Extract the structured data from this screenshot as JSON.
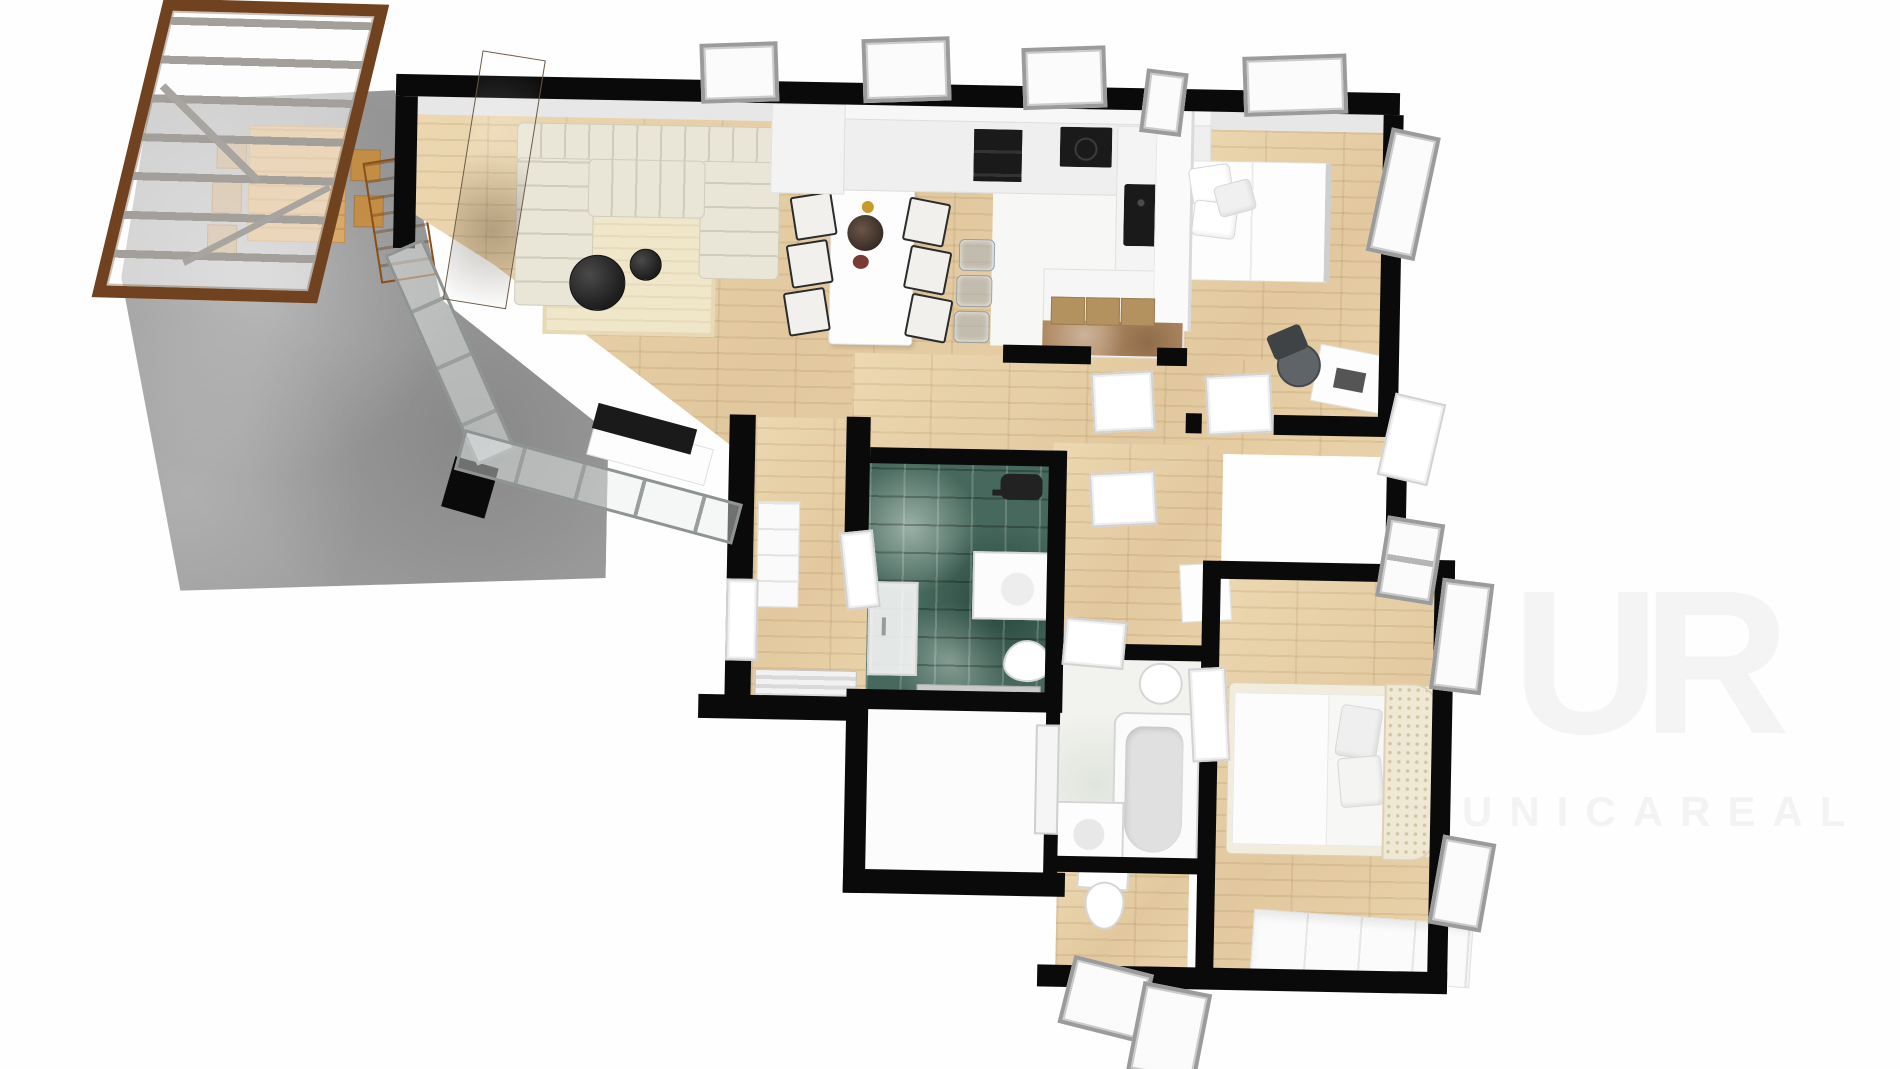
{
  "image": {
    "type": "3d-floor-plan-render",
    "view": "top-down-perspective",
    "visible_text_only": "watermark"
  },
  "watermark": {
    "logo_text": "UR",
    "brand_text": "UNICAREAL"
  },
  "palette": {
    "background": "#ffffff",
    "walls": "#0a0a0a",
    "wood_floor": "#e7d2ab",
    "terrace_concrete": "#9e9e9e",
    "bathroom_tile_teal": "#47685c",
    "sofa_cream": "#e9e6d8",
    "rug_cream": "#f0e6ca",
    "pergola_wood_brown": "#70421f",
    "pergola_beam_gray": "#a39f9a",
    "coffee_table_black": "#1d1d1d",
    "kitchen_appliance_black": "#1a1a1a",
    "island_marble_tan": "#b08a64",
    "island_tatami_tan": "#b3925f",
    "window_frame_gray": "#9b9b9b",
    "bed_linen_white": "#fafafa",
    "rattan_headboard_cream": "#efe8d4",
    "outdoor_table_wood": "#d9a96b",
    "accent_panel_taupe": "#8d7a66"
  },
  "rooms": [
    {
      "name": "terrace-patio"
    },
    {
      "name": "pergola"
    },
    {
      "name": "living-room"
    },
    {
      "name": "dining-area"
    },
    {
      "name": "kitchen"
    },
    {
      "name": "bedroom-1"
    },
    {
      "name": "hallway"
    },
    {
      "name": "entry-hall"
    },
    {
      "name": "bathroom-shower-green"
    },
    {
      "name": "utility-room"
    },
    {
      "name": "bathroom-bathtub"
    },
    {
      "name": "wc"
    },
    {
      "name": "bedroom-2"
    }
  ],
  "furniture_and_fixtures": [
    "outdoor-dining-table",
    "outdoor-chairs",
    "sectional-sofa",
    "area-rug",
    "coffee-table-large",
    "coffee-table-small",
    "tv-stand",
    "tv",
    "dining-table",
    "dining-chairs-6",
    "centerpiece-vase",
    "bar-stools-3",
    "kitchen-counter",
    "upper-cabinets",
    "double-oven",
    "cooktop",
    "kitchen-sink",
    "kitchen-island",
    "partition-wall",
    "bed-double-bedroom1",
    "pillows",
    "office-desk",
    "office-chair",
    "hall-closet",
    "entrance-door",
    "doormat",
    "shower-door",
    "vanity-sink",
    "toilet-green-bath",
    "towel-rail",
    "bathtub",
    "washbasin-cabinet",
    "toilet-bath2",
    "toilet-wc",
    "bed-king-bedroom2",
    "rattan-headboard",
    "dresser",
    "wardrobe",
    "windows",
    "doors"
  ]
}
